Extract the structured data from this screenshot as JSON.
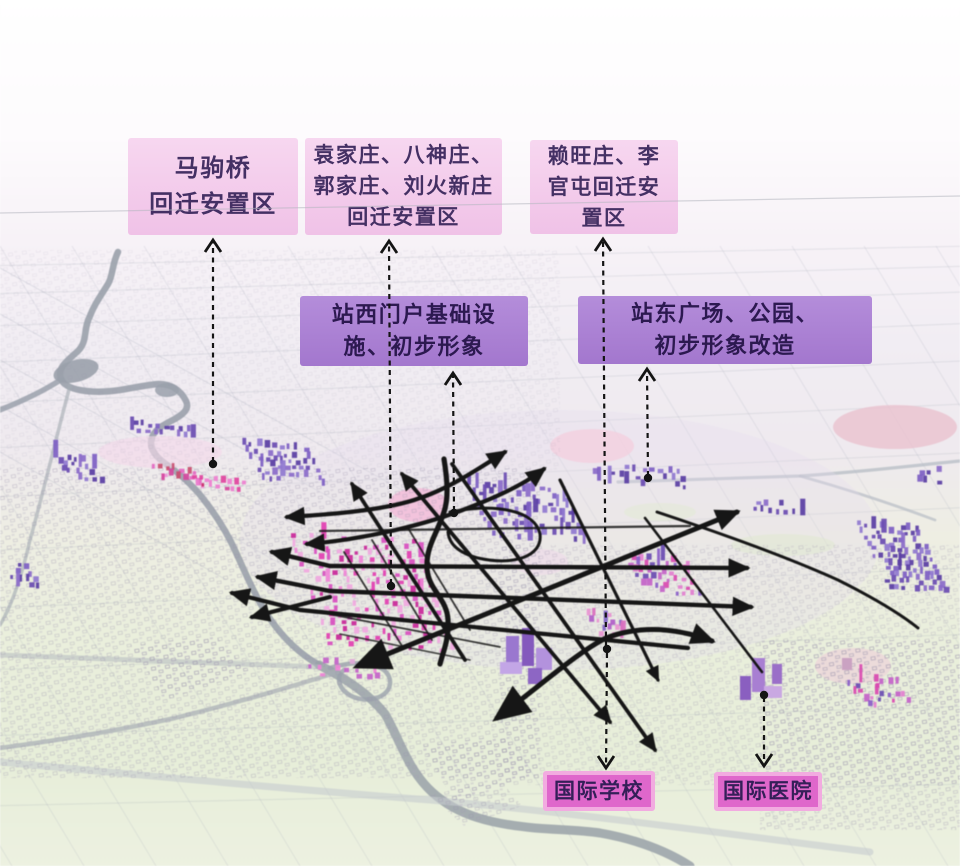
{
  "annotations": [
    {
      "id": "majuqiao",
      "style": "pink",
      "text": "马驹桥回迁安置区",
      "lines": [
        "马驹桥",
        "回迁安置区"
      ]
    },
    {
      "id": "yuanjiazhuang",
      "style": "pink",
      "text": "袁家庄、八神庄、郭家庄、刘火新庄回迁安置区",
      "lines": [
        "袁家庄、八神庄、",
        "郭家庄、刘火新庄",
        "回迁安置区"
      ]
    },
    {
      "id": "laiwangzhuang",
      "style": "pink",
      "text": "赖旺庄、李官屯回迁安置区",
      "lines": [
        "赖旺庄、李",
        "官屯回迁安",
        "置区"
      ]
    },
    {
      "id": "zhanxi",
      "style": "purple",
      "text": "站西门户基础设施、初步形象",
      "lines": [
        "站西门户基础设",
        "施、初步形象"
      ]
    },
    {
      "id": "zhandong",
      "style": "purple",
      "text": "站东广场、公园、初步形象改造",
      "lines": [
        "站东广场、公园、",
        "初步形象改造"
      ]
    },
    {
      "id": "school",
      "style": "magenta",
      "text": "国际学校",
      "lines": [
        "国际学校"
      ]
    },
    {
      "id": "hospital",
      "style": "magenta",
      "text": "国际医院",
      "lines": [
        "国际医院"
      ]
    }
  ],
  "colors": {
    "label_pink": "#f0c2e7",
    "label_purple": "#a377ce",
    "label_magenta": "#df67cb",
    "label_magenta_border": "#f2abe0",
    "text_dark": "#443064",
    "road_black": "#161616",
    "building_purple": "#7e60c4",
    "building_magenta": "#e23fb2",
    "river_grey": "#9aa1ab"
  }
}
